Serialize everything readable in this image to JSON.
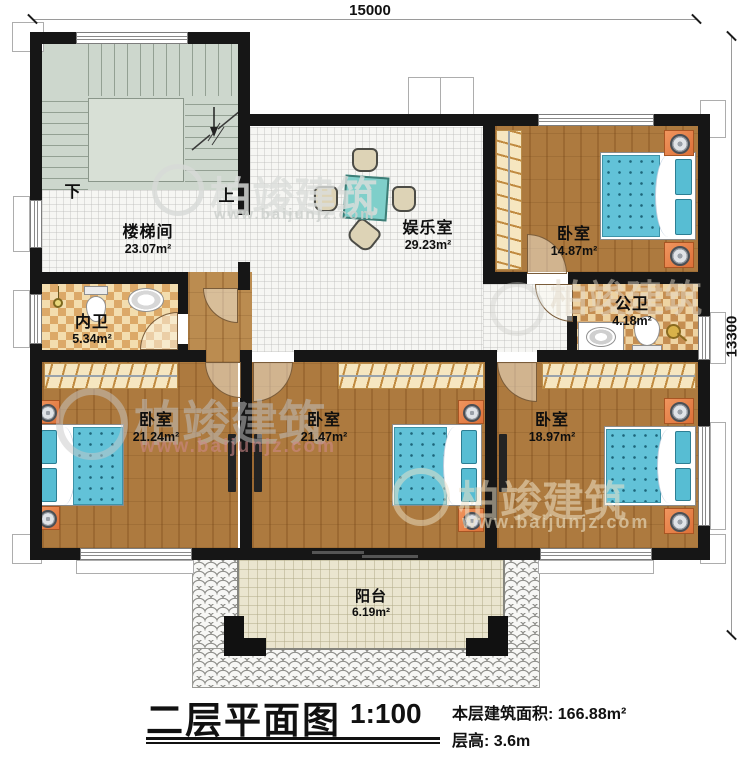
{
  "dimensions": {
    "top": "15000",
    "right": "13300"
  },
  "stairwell": {
    "name": "楼梯间",
    "area": "23.07m²",
    "down_label": "下",
    "up_label": "上"
  },
  "entertainment": {
    "name": "娱乐室",
    "area": "29.23m²"
  },
  "bedroom_ne": {
    "name": "卧室",
    "area": "14.87m²"
  },
  "bath_inner": {
    "name": "内卫",
    "area": "5.34m²"
  },
  "bath_public": {
    "name": "公卫",
    "area": "4.18m²"
  },
  "bedroom_sw": {
    "name": "卧室",
    "area": "21.24m²"
  },
  "bedroom_s": {
    "name": "卧室",
    "area": "21.47m²"
  },
  "bedroom_se": {
    "name": "卧室",
    "area": "18.97m²"
  },
  "balcony": {
    "name": "阳台",
    "area": "6.19m²"
  },
  "titleblock": {
    "title": "二层平面图",
    "scale": "1:100",
    "area_line": "本层建筑面积: 166.88m²",
    "height_line": "层高: 3.6m"
  },
  "watermark": {
    "brand": "柏竣建筑",
    "url": "www.baijunjz.com"
  },
  "colors": {
    "wall": "#161616",
    "wood_floor": "#ad7a3f",
    "mattress": "#62c2d8",
    "tile_checker": "#dca968",
    "stair_floor": "#cdd7cd",
    "balcony_floor": "#eae5cf",
    "nightstand": "#e8834a"
  }
}
